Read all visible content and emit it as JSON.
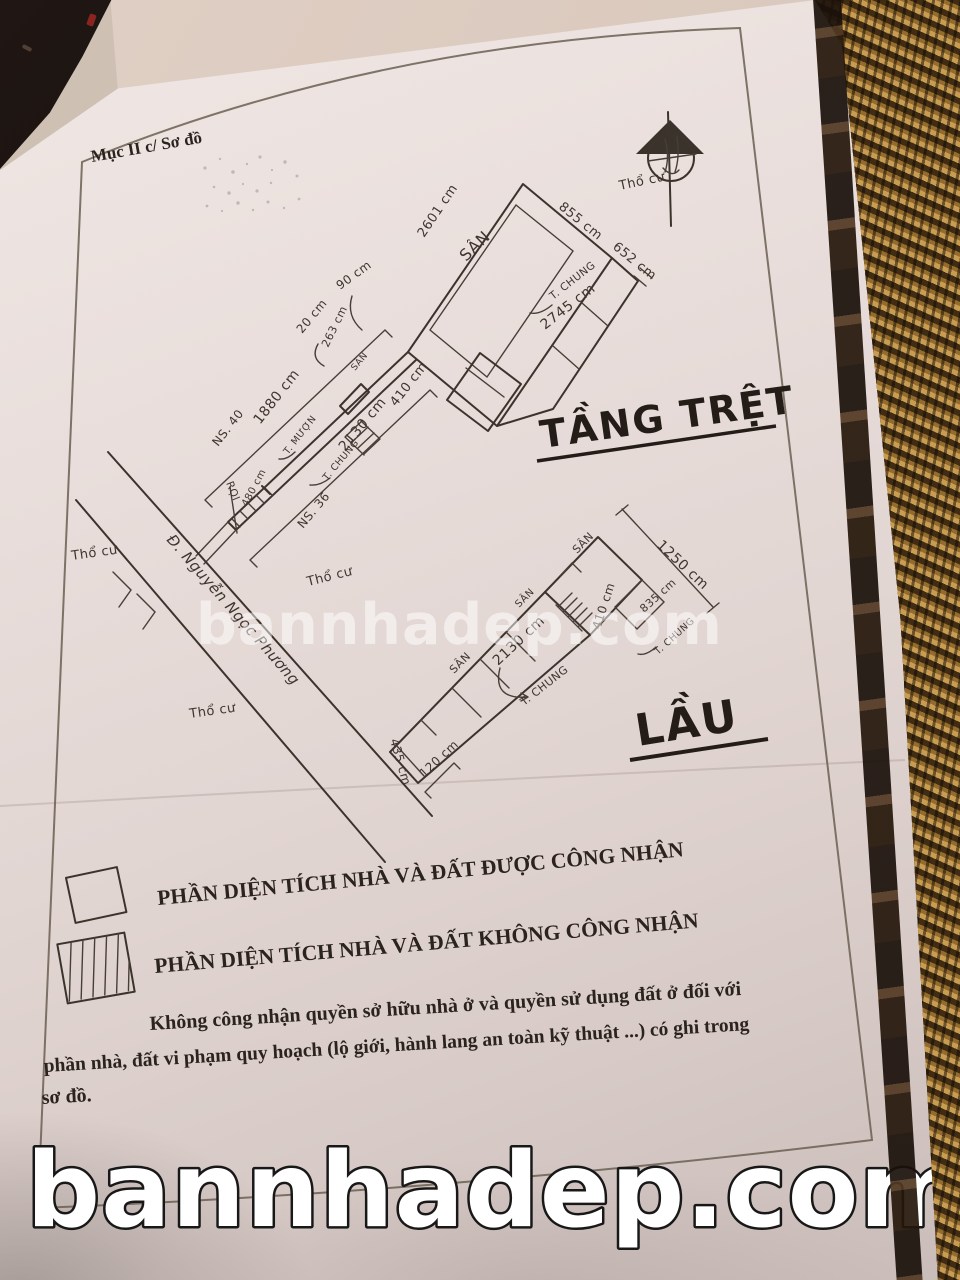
{
  "photo": {
    "watermark_center": "bannhadep.com",
    "watermark_bottom": "bannhadep.com"
  },
  "form": {
    "section_label": "Mục II c/ Sơ đồ",
    "legend": {
      "recognized_label": "PHẦN DIỆN TÍCH NHÀ VÀ ĐẤT ĐƯỢC CÔNG NHẬN",
      "not_recognized_label": "PHẦN DIỆN TÍCH NHÀ VÀ ĐẤT KHÔNG CÔNG NHẬN"
    },
    "note": {
      "line1": "Không công nhận quyền sở hữu nhà ở và quyền sử dụng đất ở đối với",
      "line2": "phần nhà, đất vi phạm quy hoạch (lộ giới, hành lang an toàn kỹ thuật ...) có ghi trong",
      "line3": "sơ đồ."
    }
  },
  "site": {
    "compass_label": "Thổ cư",
    "street_name": "Đ. Nguyễn Ngọc Phương",
    "tho_cu_left": "Thổ cư",
    "tho_cu_mid": "Thổ cư",
    "tho_cu_bottom": "Thổ cư"
  },
  "ground_floor": {
    "title": "TẦNG TRỆT",
    "dims": {
      "top_edge": "855 cm",
      "right_edge": "652 cm",
      "left_edge": "2601 cm",
      "bottom_edge": "2745 cm",
      "block": "410 cm",
      "gate_width": "90 cm",
      "gate_offset": "20 cm",
      "parcel": "263 cm",
      "house_len_1": "1880 cm",
      "house_len_2": "2130 cm",
      "strip": "480 cm"
    },
    "walls": {
      "t_chung_top": "T. CHUNG",
      "t_chung_mid": "T. CHUNG",
      "t_muon": "T. MƯỢN"
    },
    "house_no_left": "NS. 40",
    "house_no_right": "NS. 36",
    "yard_big": "SÂN",
    "yard_small": "SÂN",
    "roi": "RỌI"
  },
  "upper_floor": {
    "title": "LẦU",
    "dims": {
      "right_edge": "1250 cm",
      "stair_block": "410 cm",
      "side": "835 cm",
      "length": "2130 cm",
      "end_1": "120 cm",
      "end_2": "435 cm"
    },
    "walls": {
      "t_chung_right": "T. CHUNG",
      "t_chung_bottom": "T. CHUNG"
    },
    "yard_1": "SÂN",
    "yard_2": "SÂN",
    "yard_3": "SÂN"
  }
}
